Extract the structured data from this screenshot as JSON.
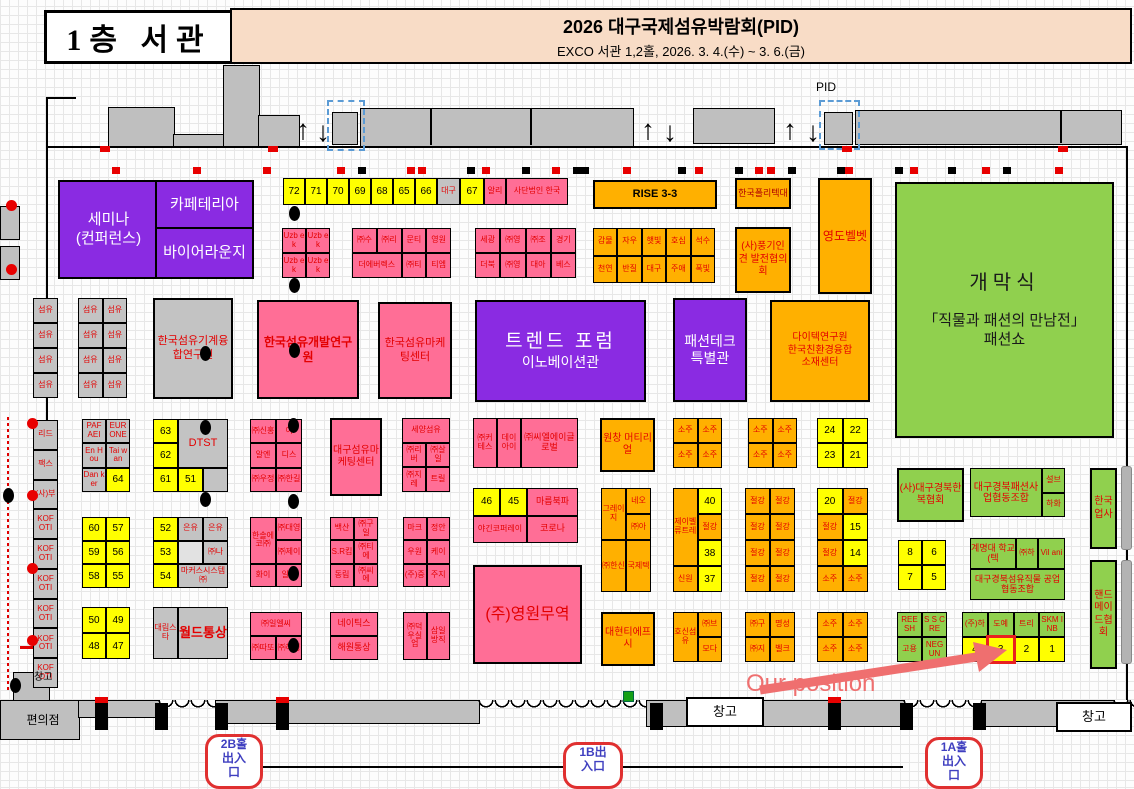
{
  "colors": {
    "pink": "#ff6e96",
    "purple": "#8a2be2",
    "orange": "#ffb000",
    "yellow": "#ffff00",
    "green": "#90d04e",
    "gray": "#c3c3c3",
    "highlight_red": "#e82020",
    "annotation": "#ef6f6f"
  },
  "header": {
    "floor": "1층  서관",
    "title": "2026 대구국제섬유박람회(PID)",
    "subtitle": "EXCO 서관 1,2홀, 2026. 3. 4.(수) ~ 3. 6.(금)"
  },
  "labels": {
    "convenience": "편의점",
    "warehouse": "창고",
    "pid": "PID",
    "our_position": "Our position",
    "entrance_2b": "2B홀\n出入\n口",
    "entrance_1b": "1B出\n入口",
    "entrance_1a": "1A홀\n出入\n口"
  },
  "boxes": {
    "seminar": {
      "label": "세미나\n(컨퍼런스)"
    },
    "cafeteria": {
      "label": "카페테리아"
    },
    "buyer": {
      "label": "바이어라운지"
    },
    "tmachine": {
      "label": "한국섬유기계융합연구원"
    },
    "tdev": {
      "label": "한국섬유개발연구원"
    },
    "tmkt": {
      "label": "한국섬유마케팅센터"
    },
    "trend": {
      "title": "트렌드  포럼",
      "sub": "이노베이션관"
    },
    "ftech": {
      "label": "패션테크\n특별관"
    },
    "dyetec": {
      "label": "다이텍연구원\n한국친환경융합\n소재센터"
    },
    "opening": {
      "title": "개막식",
      "sub": "「직물과 패션의 만남전」\n패션쇼"
    },
    "rise": {
      "label": "RISE 3-3"
    },
    "polytech": {
      "label": "한국폴리텍대"
    },
    "yeongdo": {
      "label": "영도벨벳"
    },
    "punggi": {
      "label": "(사)풍기인견 발전협의회"
    },
    "wonchang": {
      "label": "원창 머티리얼"
    },
    "daehyun": {
      "label": "대현티에프시"
    },
    "yeongwon": {
      "label": "(주)영원무역"
    },
    "dgmkt": {
      "label": "대구섬유마케팅센터"
    },
    "hanbok": {
      "label": "(사)대구경북한복협회"
    },
    "upsa": {
      "label": "한국업사"
    },
    "handmade": {
      "label": "핸드메이드협회"
    }
  },
  "groups": {
    "toprow": [
      {
        "t": "72",
        "c": "y"
      },
      {
        "t": "71",
        "c": "y"
      },
      {
        "t": "70",
        "c": "y"
      },
      {
        "t": "69",
        "c": "y"
      },
      {
        "t": "68",
        "c": "y"
      },
      {
        "t": "65",
        "c": "y"
      },
      {
        "t": "66",
        "c": "y"
      },
      {
        "t": "대구",
        "c": "gy"
      },
      {
        "t": "67",
        "c": "y"
      },
      {
        "t": "알리",
        "c": "pk"
      },
      {
        "t": "사단법인 한국",
        "c": "pk"
      }
    ],
    "uzbek": [
      {
        "t": "Uzb ek",
        "c": "pk"
      },
      {
        "t": "Uzb ek",
        "c": "pk"
      },
      {
        "t": "Uzb ek",
        "c": "pk"
      },
      {
        "t": "Uzb ek",
        "c": "pk"
      }
    ],
    "pink_a": [
      {
        "t": "㈜수",
        "c": "pk"
      },
      {
        "t": "㈜리",
        "c": "pk"
      },
      {
        "t": "문티",
        "c": "pk"
      },
      {
        "t": "영원",
        "c": "pk"
      },
      {
        "t": "더에버렉스",
        "c": "pk",
        "s": 2
      },
      {
        "t": "㈜티",
        "c": "pk"
      },
      {
        "t": "티엠",
        "c": "pk"
      }
    ],
    "pink_b": [
      {
        "t": "세광",
        "c": "pk"
      },
      {
        "t": "㈜영",
        "c": "pk"
      },
      {
        "t": "㈜조",
        "c": "pk"
      },
      {
        "t": "경기",
        "c": "pk"
      },
      {
        "t": "더북",
        "c": "pk"
      },
      {
        "t": "㈜영",
        "c": "pk"
      },
      {
        "t": "대아",
        "c": "pk"
      },
      {
        "t": "베스",
        "c": "pk"
      }
    ],
    "orange_a": [
      {
        "t": "감물",
        "c": "og"
      },
      {
        "t": "자우",
        "c": "og"
      },
      {
        "t": "햇빛",
        "c": "og"
      },
      {
        "t": "호심",
        "c": "og"
      },
      {
        "t": "석수",
        "c": "og"
      },
      {
        "t": "천연",
        "c": "og"
      },
      {
        "t": "반질",
        "c": "og"
      },
      {
        "t": "대구",
        "c": "og"
      },
      {
        "t": "주애",
        "c": "og"
      },
      {
        "t": "폭빛",
        "c": "og"
      }
    ],
    "sumyu_a": [
      {
        "t": "섬유",
        "c": "gy"
      },
      {
        "t": "섬유",
        "c": "gy"
      },
      {
        "t": "섬유",
        "c": "gy"
      },
      {
        "t": "섬유",
        "c": "gy"
      }
    ],
    "sumyu_b": [
      {
        "t": "섬유",
        "c": "gy"
      },
      {
        "t": "섬유",
        "c": "gy"
      },
      {
        "t": "섬유",
        "c": "gy"
      },
      {
        "t": "섬유",
        "c": "gy"
      },
      {
        "t": "섬유",
        "c": "gy"
      },
      {
        "t": "섬유",
        "c": "gy"
      },
      {
        "t": "섬유",
        "c": "gy"
      },
      {
        "t": "섬유",
        "c": "gy"
      }
    ],
    "left_col": [
      {
        "t": "리드",
        "c": "gy"
      },
      {
        "t": "팩스",
        "c": "gy"
      },
      {
        "t": "(사)부",
        "c": "gy"
      },
      {
        "t": "KOF OTI",
        "c": "gy"
      },
      {
        "t": "KOF OTI",
        "c": "gy"
      },
      {
        "t": "KOF OTI",
        "c": "gy"
      },
      {
        "t": "KOF OTI",
        "c": "gy"
      },
      {
        "t": "KOF OTI",
        "c": "gy"
      },
      {
        "t": "KOF OTI",
        "c": "gy"
      }
    ],
    "paf": [
      {
        "t": "PAF AEI",
        "c": "gy"
      },
      {
        "t": "EUR ONE",
        "c": "gy"
      },
      {
        "t": "En Hou",
        "c": "gy"
      },
      {
        "t": "Tai wan",
        "c": "gy"
      },
      {
        "t": "Dan ker",
        "c": "gy"
      },
      {
        "t": "64",
        "c": "y"
      }
    ],
    "y60": [
      {
        "t": "60",
        "c": "y"
      },
      {
        "t": "57",
        "c": "y"
      },
      {
        "t": "59",
        "c": "y"
      },
      {
        "t": "56",
        "c": "y"
      },
      {
        "t": "58",
        "c": "y"
      },
      {
        "t": "55",
        "c": "y"
      }
    ],
    "y50": [
      {
        "t": "50",
        "c": "y"
      },
      {
        "t": "49",
        "c": "y"
      },
      {
        "t": "48",
        "c": "y"
      },
      {
        "t": "47",
        "c": "y"
      }
    ],
    "dtst": [
      {
        "t": "63",
        "c": "y"
      },
      {
        "t": "DTST",
        "c": "gy",
        "s": 2,
        "r": 2,
        "f": "f11"
      },
      {
        "t": "62",
        "c": "y"
      },
      {
        "t": "61",
        "c": "y"
      },
      {
        "t": "51",
        "c": "y"
      },
      {
        "t": "",
        "c": "gy"
      }
    ],
    "eunyu": [
      {
        "t": "52",
        "c": "y"
      },
      {
        "t": "은유",
        "c": "gy"
      },
      {
        "t": "은유",
        "c": "gy"
      },
      {
        "t": "53",
        "c": "y"
      },
      {
        "t": "",
        "c": "lg"
      },
      {
        "t": "㈜나",
        "c": "gy"
      },
      {
        "t": "54",
        "c": "y"
      },
      {
        "t": "마커스시스템㈜",
        "c": "gy",
        "s": 2
      }
    ],
    "world": [
      {
        "t": "대림스타",
        "c": "gy"
      },
      {
        "t": "월드통상",
        "c": "gy",
        "f": "f13"
      }
    ],
    "g1": [
      {
        "t": "㈜신홍",
        "c": "pk"
      },
      {
        "t": "이",
        "c": "pk"
      },
      {
        "t": "알엔",
        "c": "pk"
      },
      {
        "t": "디스",
        "c": "pk"
      },
      {
        "t": "㈜우정",
        "c": "pk"
      },
      {
        "t": "㈜한길",
        "c": "pk"
      }
    ],
    "seyang": [
      {
        "t": "세양섬유",
        "c": "pk",
        "s": 2
      },
      {
        "t": "㈜리버",
        "c": "pk"
      },
      {
        "t": "㈜살일",
        "c": "pk"
      },
      {
        "t": "㈜지레",
        "c": "pk"
      },
      {
        "t": "트릴",
        "c": "pk"
      }
    ],
    "cl": [
      {
        "t": "㈜커테스",
        "c": "pk"
      },
      {
        "t": "데이아이",
        "c": "pk"
      },
      {
        "t": "㈜씨엘에이글로벌",
        "c": "pk",
        "f": "f9"
      }
    ],
    "y4645": [
      {
        "t": "46",
        "c": "y"
      },
      {
        "t": "45",
        "c": "y"
      },
      {
        "t": "마름북파",
        "c": "pk",
        "f": "f9"
      },
      {
        "t": "야긴코퍼레이",
        "c": "pk",
        "s": 2
      },
      {
        "t": "코로나",
        "c": "pk",
        "f": "f9"
      }
    ],
    "g5": [
      {
        "t": "한솔에코㈜",
        "c": "pk",
        "r": 2
      },
      {
        "t": "㈜대영",
        "c": "pk"
      },
      {
        "t": "㈜제이",
        "c": "pk"
      },
      {
        "t": "화이",
        "c": "pk"
      },
      {
        "t": "일언",
        "c": "pk"
      }
    ],
    "g6": [
      {
        "t": "백산",
        "c": "pk"
      },
      {
        "t": "㈜구일",
        "c": "pk"
      },
      {
        "t": "S.R킴",
        "c": "pk"
      },
      {
        "t": "㈜티에",
        "c": "pk"
      },
      {
        "t": "동림",
        "c": "pk"
      },
      {
        "t": "㈜씨에",
        "c": "pk"
      }
    ],
    "g7": [
      {
        "t": "마크",
        "c": "pk"
      },
      {
        "t": "정안",
        "c": "pk"
      },
      {
        "t": "우원",
        "c": "pk"
      },
      {
        "t": "케이",
        "c": "pk"
      },
      {
        "t": "(주)중",
        "c": "pk"
      },
      {
        "t": "주지",
        "c": "pk"
      }
    ],
    "g8": [
      {
        "t": "㈜일엘씨",
        "c": "pk",
        "s": 2
      },
      {
        "t": "㈜따또",
        "c": "pk"
      },
      {
        "t": "㈜해성",
        "c": "pk"
      }
    ],
    "g9": [
      {
        "t": "네이틱스",
        "c": "pk",
        "f": "f9"
      },
      {
        "t": "해원통상",
        "c": "pk",
        "f": "f9"
      }
    ],
    "g10": [
      {
        "t": "㈜덕우실업",
        "c": "pk"
      },
      {
        "t": "삼일방직",
        "c": "pk"
      }
    ],
    "soju_a": [
      {
        "t": "소주",
        "c": "og"
      },
      {
        "t": "소주",
        "c": "og"
      },
      {
        "t": "소주",
        "c": "og"
      },
      {
        "t": "소주",
        "c": "og"
      }
    ],
    "soju_b": [
      {
        "t": "소주",
        "c": "og"
      },
      {
        "t": "소주",
        "c": "og"
      },
      {
        "t": "소주",
        "c": "og"
      },
      {
        "t": "소주",
        "c": "og"
      }
    ],
    "soju_c": [
      {
        "t": "소주",
        "c": "og"
      },
      {
        "t": "소주",
        "c": "og"
      },
      {
        "t": "소주",
        "c": "og"
      },
      {
        "t": "소주",
        "c": "og"
      }
    ],
    "y24": [
      {
        "t": "24",
        "c": "y"
      },
      {
        "t": "22",
        "c": "y"
      },
      {
        "t": "23",
        "c": "y"
      },
      {
        "t": "21",
        "c": "y"
      }
    ],
    "col_a": [
      {
        "t": "그레이지",
        "c": "og",
        "r": 2
      },
      {
        "t": "네오",
        "c": "og"
      },
      {
        "t": "㈜아",
        "c": "og"
      },
      {
        "t": "㈜한신",
        "c": "og",
        "r": 2
      },
      {
        "t": "국제텍",
        "c": "og",
        "r": 2
      }
    ],
    "col_b": [
      {
        "t": "제이벨류트레",
        "c": "og",
        "r": 3
      },
      {
        "t": "40",
        "c": "y"
      },
      {
        "t": "절강",
        "c": "og"
      },
      {
        "t": "38",
        "c": "y"
      },
      {
        "t": "신원",
        "c": "og"
      },
      {
        "t": "37",
        "c": "y"
      }
    ],
    "col_c": [
      {
        "t": "절강",
        "c": "og"
      },
      {
        "t": "절강",
        "c": "og"
      },
      {
        "t": "절강",
        "c": "og"
      },
      {
        "t": "절강",
        "c": "og"
      },
      {
        "t": "절강",
        "c": "og"
      },
      {
        "t": "절강",
        "c": "og"
      },
      {
        "t": "절강",
        "c": "og"
      },
      {
        "t": "절강",
        "c": "og"
      }
    ],
    "col_d": [
      {
        "t": "20",
        "c": "y"
      },
      {
        "t": "절강",
        "c": "og"
      },
      {
        "t": "절강",
        "c": "og"
      },
      {
        "t": "15",
        "c": "y"
      },
      {
        "t": "절강",
        "c": "og"
      },
      {
        "t": "14",
        "c": "y"
      },
      {
        "t": "소주",
        "c": "og"
      },
      {
        "t": "소주",
        "c": "og"
      }
    ],
    "hosin": [
      {
        "t": "호신섬유",
        "c": "og",
        "r": 2
      },
      {
        "t": "㈜브",
        "c": "og"
      },
      {
        "t": "모다",
        "c": "og"
      }
    ],
    "myeong": [
      {
        "t": "㈜구",
        "c": "og"
      },
      {
        "t": "명성",
        "c": "og"
      },
      {
        "t": "㈜지",
        "c": "og"
      },
      {
        "t": "벨크",
        "c": "og"
      }
    ],
    "coop": [
      {
        "t": "대구경북패션사업협동조합",
        "c": "gn",
        "r": 2,
        "f": "f10"
      },
      {
        "t": "설브",
        "c": "gn"
      },
      {
        "t": "하화",
        "c": "gn"
      }
    ],
    "y8": [
      {
        "t": "8",
        "c": "y"
      },
      {
        "t": "6",
        "c": "y"
      },
      {
        "t": "7",
        "c": "y"
      },
      {
        "t": "5",
        "c": "y"
      }
    ],
    "keimyung": [
      {
        "t": "계명대 학교(텍",
        "c": "gn",
        "f": "f9"
      },
      {
        "t": "㈜하",
        "c": "gn"
      },
      {
        "t": "Vil ani",
        "c": "gn"
      },
      {
        "t": "대구경북섬유직물 공업협동조합",
        "c": "gn",
        "s": 3,
        "f": "f9"
      }
    ],
    "reesh": [
      {
        "t": "REE SH",
        "c": "gn"
      },
      {
        "t": "S S CRE",
        "c": "gn"
      },
      {
        "t": "고용",
        "c": "gn"
      },
      {
        "t": "NEG UN",
        "c": "gn"
      }
    ],
    "pos": [
      {
        "t": "(주)하",
        "c": "gn"
      },
      {
        "t": "도예",
        "c": "gn"
      },
      {
        "t": "트리",
        "c": "gn"
      },
      {
        "t": "SKM INB",
        "c": "gn"
      },
      {
        "t": "4",
        "c": "y"
      },
      {
        "t": "3",
        "c": "y",
        "f": "hl"
      },
      {
        "t": "2",
        "c": "y"
      },
      {
        "t": "1",
        "c": "y"
      }
    ]
  }
}
